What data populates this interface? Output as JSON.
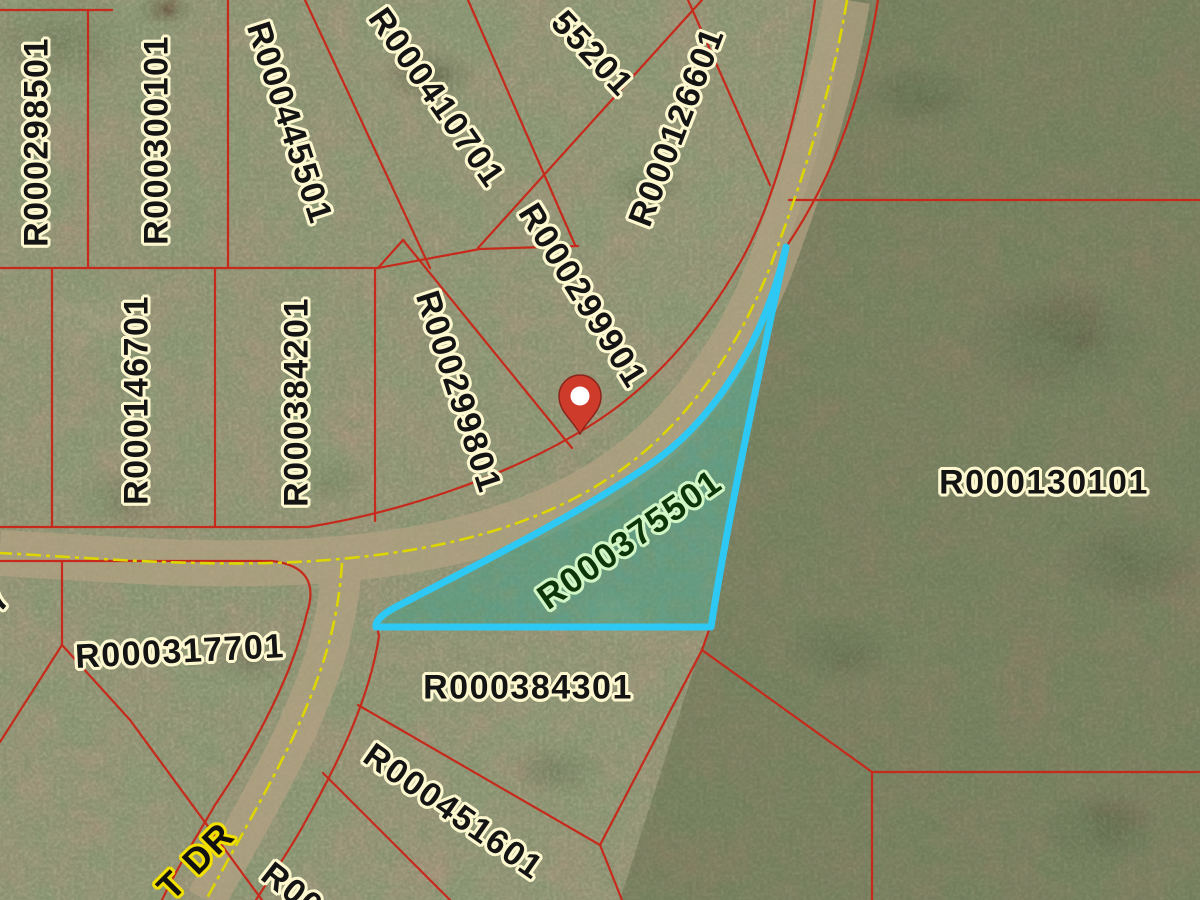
{
  "map": {
    "type": "gis-parcel-aerial-view",
    "highlighted_parcel_id": "R000375501",
    "street_label": "T DR",
    "pin": {
      "x": 580,
      "y": 434
    },
    "colors": {
      "parcel_line": "#c7291b",
      "highlight_outline": "#2ec8f4",
      "highlight_fill": "rgba(58,160,128,0.40)",
      "label_text": "#141414",
      "label_halo": "#fdf8cf",
      "green_label_text": "#0c3509",
      "green_label_halo": "#d2f6c6",
      "street_label_halo": "#f2e000",
      "road_centerline": "#ded600",
      "pin_fill": "#ce3b2b"
    },
    "parcel_labels": [
      {
        "text": "R000298501",
        "x": 37,
        "y": 142,
        "rot": -90,
        "style": "cream"
      },
      {
        "text": "R000300101",
        "x": 157,
        "y": 140,
        "rot": -90,
        "style": "cream"
      },
      {
        "text": "R000445501",
        "x": 289,
        "y": 123,
        "rot": 72,
        "style": "cream"
      },
      {
        "text": "R000410701",
        "x": 436,
        "y": 98,
        "rot": 55,
        "style": "cream"
      },
      {
        "text": "55201",
        "x": 592,
        "y": 54,
        "rot": 47,
        "style": "cream"
      },
      {
        "text": "R000126601",
        "x": 677,
        "y": 127,
        "rot": -69,
        "style": "cream"
      },
      {
        "text": "R000146701",
        "x": 137,
        "y": 400,
        "rot": -90,
        "style": "cream"
      },
      {
        "text": "R000384201",
        "x": 297,
        "y": 402,
        "rot": -90,
        "style": "cream"
      },
      {
        "text": "R000299801",
        "x": 458,
        "y": 392,
        "rot": 72,
        "style": "cream"
      },
      {
        "text": "R000299901",
        "x": 582,
        "y": 296,
        "rot": 58,
        "style": "cream"
      },
      {
        "text": "R000130101",
        "x": 1044,
        "y": 483,
        "rot": 0,
        "style": "cream"
      },
      {
        "text": "R000317701",
        "x": 180,
        "y": 652,
        "rot": -3,
        "style": "cream"
      },
      {
        "text": "R000384301",
        "x": 528,
        "y": 688,
        "rot": 0,
        "style": "cream"
      },
      {
        "text": "R000451601",
        "x": 453,
        "y": 812,
        "rot": 35,
        "style": "cream"
      },
      {
        "text": "R000",
        "x": 300,
        "y": 897,
        "rot": 38,
        "style": "cream"
      },
      {
        "text": "57",
        "x": -8,
        "y": 607,
        "rot": -52,
        "style": "cream"
      },
      {
        "text": "R000375501",
        "x": 630,
        "y": 540,
        "rot": -35,
        "style": "green"
      },
      {
        "text": "T DR",
        "x": 196,
        "y": 861,
        "rot": -45,
        "style": "street"
      }
    ]
  }
}
